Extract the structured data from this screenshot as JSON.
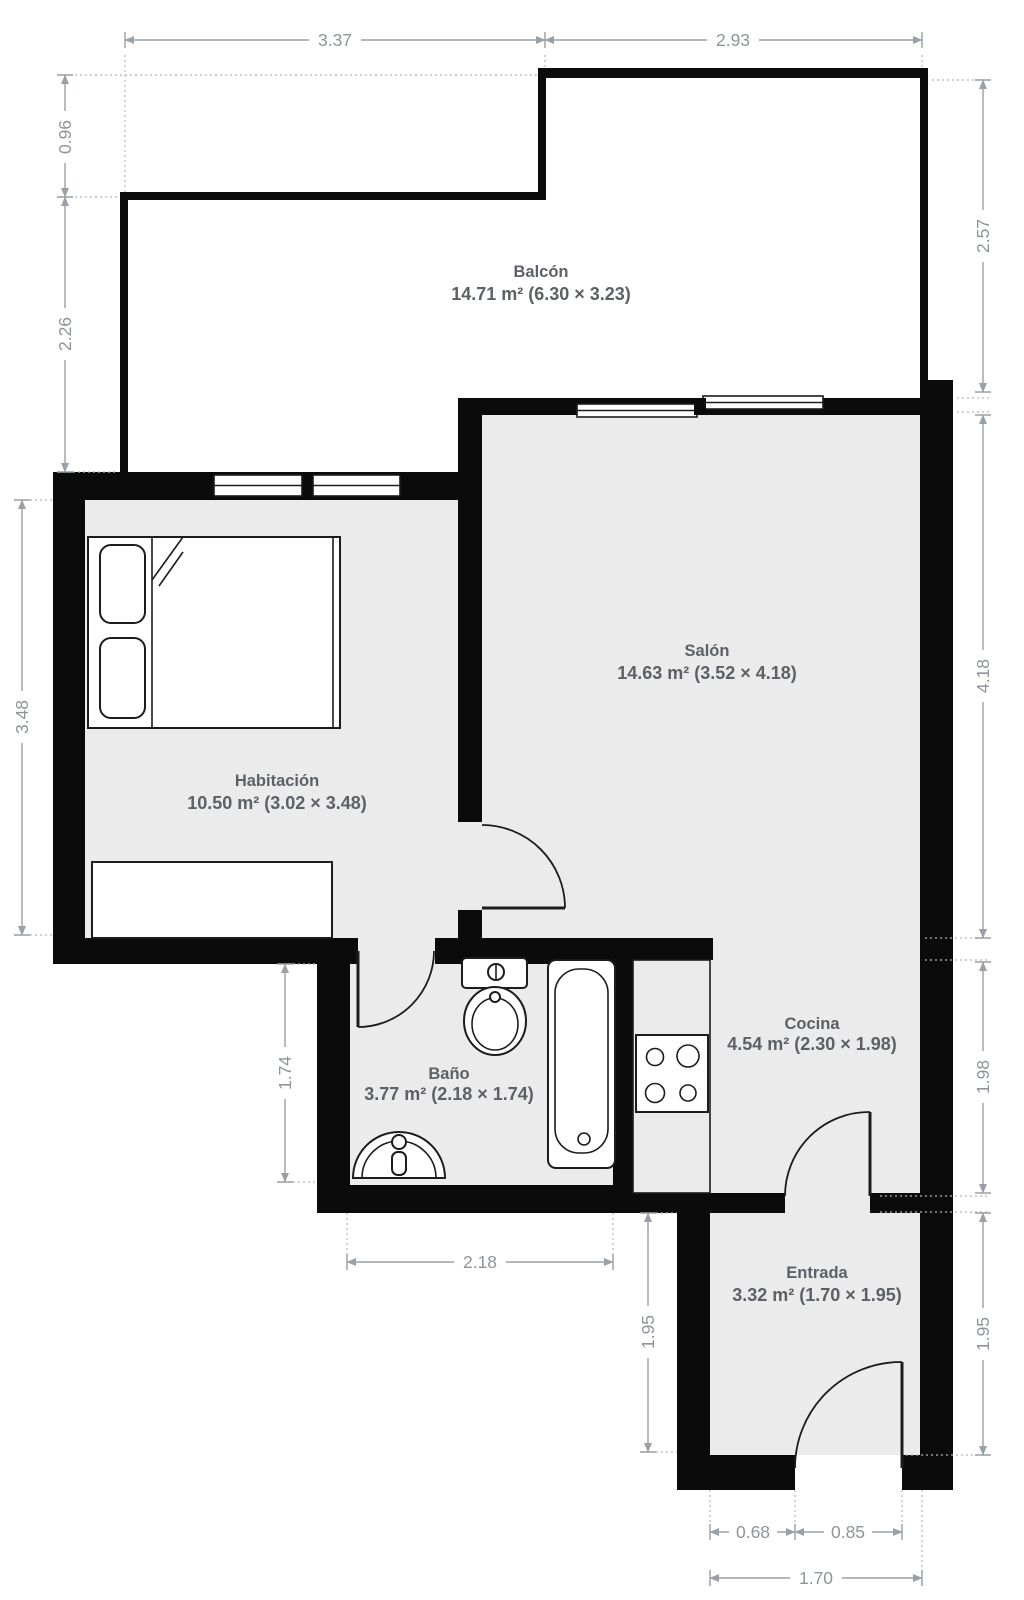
{
  "plan": {
    "type": "floorplan",
    "colors": {
      "background": "#ffffff",
      "floor_fill": "#ebebeb",
      "wall": "#0b0b0b",
      "dimension": "#9aa0a6",
      "room_label": "#5d6166"
    },
    "rooms": {
      "balcon": {
        "name": "Balcón",
        "area": "14.71 m² (6.30 × 3.23)"
      },
      "salon": {
        "name": "Salón",
        "area": "14.63 m² (3.52 × 4.18)"
      },
      "habitacion": {
        "name": "Habitación",
        "area": "10.50 m² (3.02 × 3.48)"
      },
      "bano": {
        "name": "Baño",
        "area": "3.77 m² (2.18 × 1.74)"
      },
      "cocina": {
        "name": "Cocina",
        "area": "4.54 m² (2.30 × 1.98)"
      },
      "entrada": {
        "name": "Entrada",
        "area": "3.32 m² (1.70 × 1.95)"
      }
    },
    "dims": {
      "top_left": "3.37",
      "top_right": "2.93",
      "left_upper": "0.96",
      "left_mid": "2.26",
      "left_bedroom": "3.48",
      "bath_height": "1.74",
      "right_balcony": "2.57",
      "right_salon": "4.18",
      "right_cocina": "1.98",
      "right_entrada": "1.95",
      "entrada_left": "1.95",
      "bath_width": "2.18",
      "entry_offset": "0.68",
      "entry_door": "0.85",
      "entrada_width": "1.70"
    }
  }
}
